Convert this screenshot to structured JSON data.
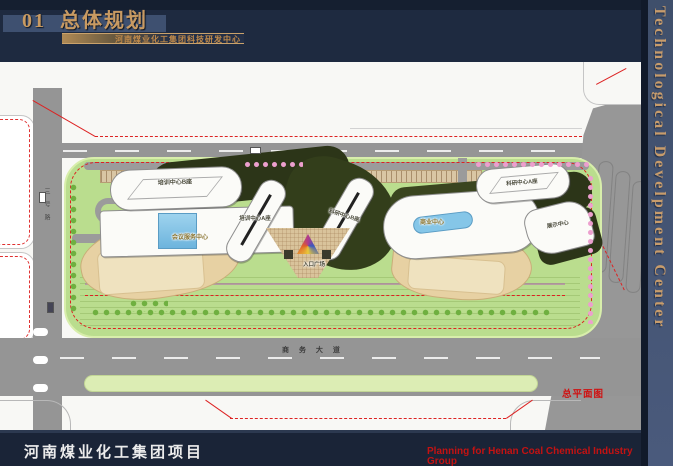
{
  "header": {
    "section_number": "01",
    "title": "总体规划",
    "subtitle": "河南煤业化工集团科技研发中心"
  },
  "side_banner": {
    "text": "Technological Develpment Center"
  },
  "plan": {
    "drawing_label": "总平面图",
    "roads": {
      "south_avenue": "商 务 大 道",
      "west_road": "三号路"
    },
    "plaza_label": "入口广场",
    "buildings": [
      {
        "id": "training-center-b",
        "label": "培训中心B座"
      },
      {
        "id": "conference-service-center",
        "label": "会议服务中心"
      },
      {
        "id": "training-center-a",
        "label": "培训中心A座"
      },
      {
        "id": "research-center-b",
        "label": "科研中心B座"
      },
      {
        "id": "commercial-center",
        "label": "商业中心"
      },
      {
        "id": "research-center-a",
        "label": "科研中心A座"
      },
      {
        "id": "exhibition-center",
        "label": "展示中心"
      }
    ],
    "colors": {
      "background_navy": "#1e2a40",
      "site_green": "#badd8e",
      "road_gray": "#959595",
      "boundary_red": "#dd2222",
      "building_tan": "#e7d1a3",
      "water_blue": "#85c6e8",
      "accent_gold": "#c79c6c"
    }
  },
  "footer": {
    "project_label": "河南煤业化工集团项目",
    "caption_line1": "Planning for Henan Coal Chemical Industry Group",
    "caption_line2": "Technological Develpment Center"
  }
}
